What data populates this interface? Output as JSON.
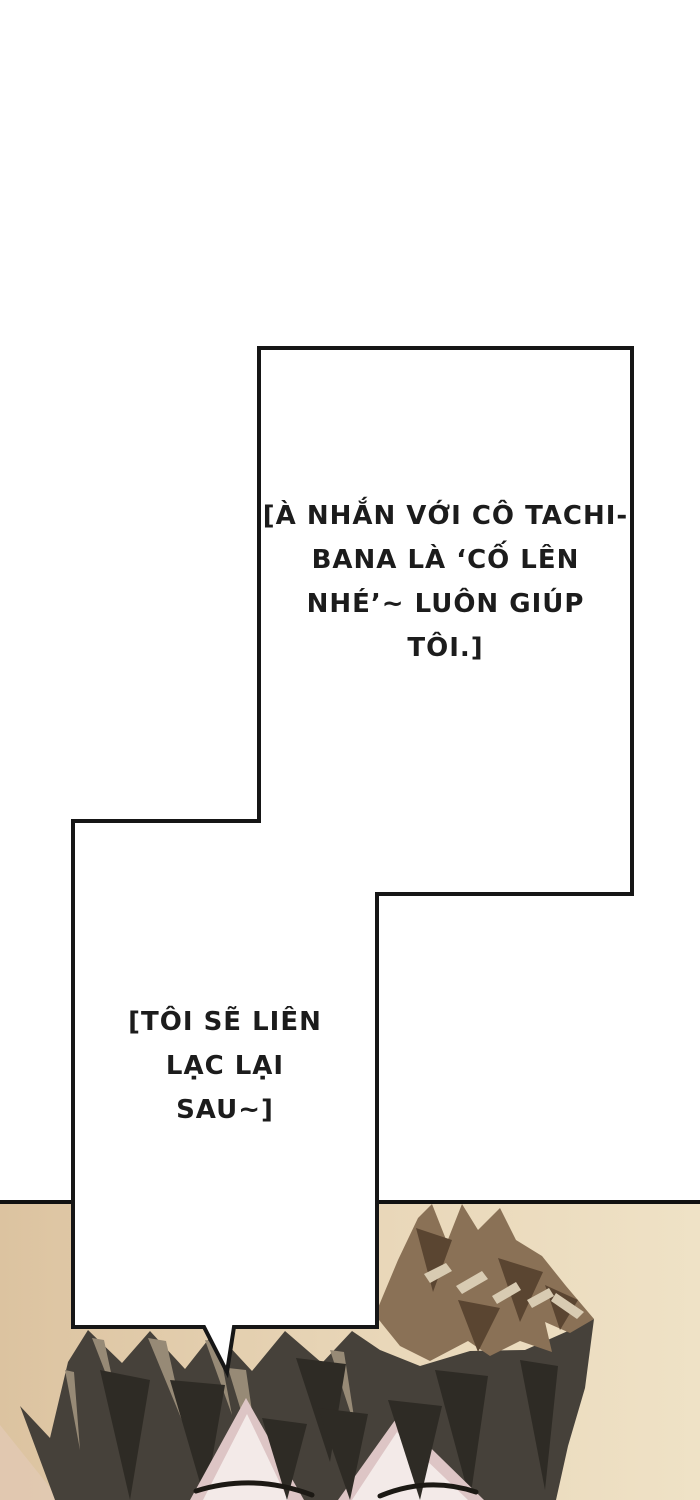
{
  "bubble": {
    "dialogue1": "[À NHẮN VỚI CÔ TACHI-\nBANA LÀ ‘CỐ LÊN\nNHÉ’~ LUÔN GIÚP\nTÔI.]",
    "dialogue2": "[TÔI SẼ LIÊN\nLẠC LẠI\nSAU~]",
    "border_color": "#161616",
    "fill_color": "#ffffff",
    "text_color": "#1c1c1c"
  },
  "artwork": {
    "colors": {
      "bg_left": "#dcc3a0",
      "bg_mid": "#e9d7b9",
      "bg_right": "#efe2c6",
      "bg_pink": "#e3cab6",
      "panel_border": "#111111",
      "hair_dark": "#46413a",
      "hair_darker": "#2e2b25",
      "hair_light": "#978a76",
      "hair_brown": "#8a7156",
      "hair_brown_dark": "#5a4531",
      "hair_highlight": "#d8cbb2",
      "skin": "#f3eae8",
      "skin_shadow": "#ddc5c5",
      "glasses": "#1c1914"
    }
  }
}
